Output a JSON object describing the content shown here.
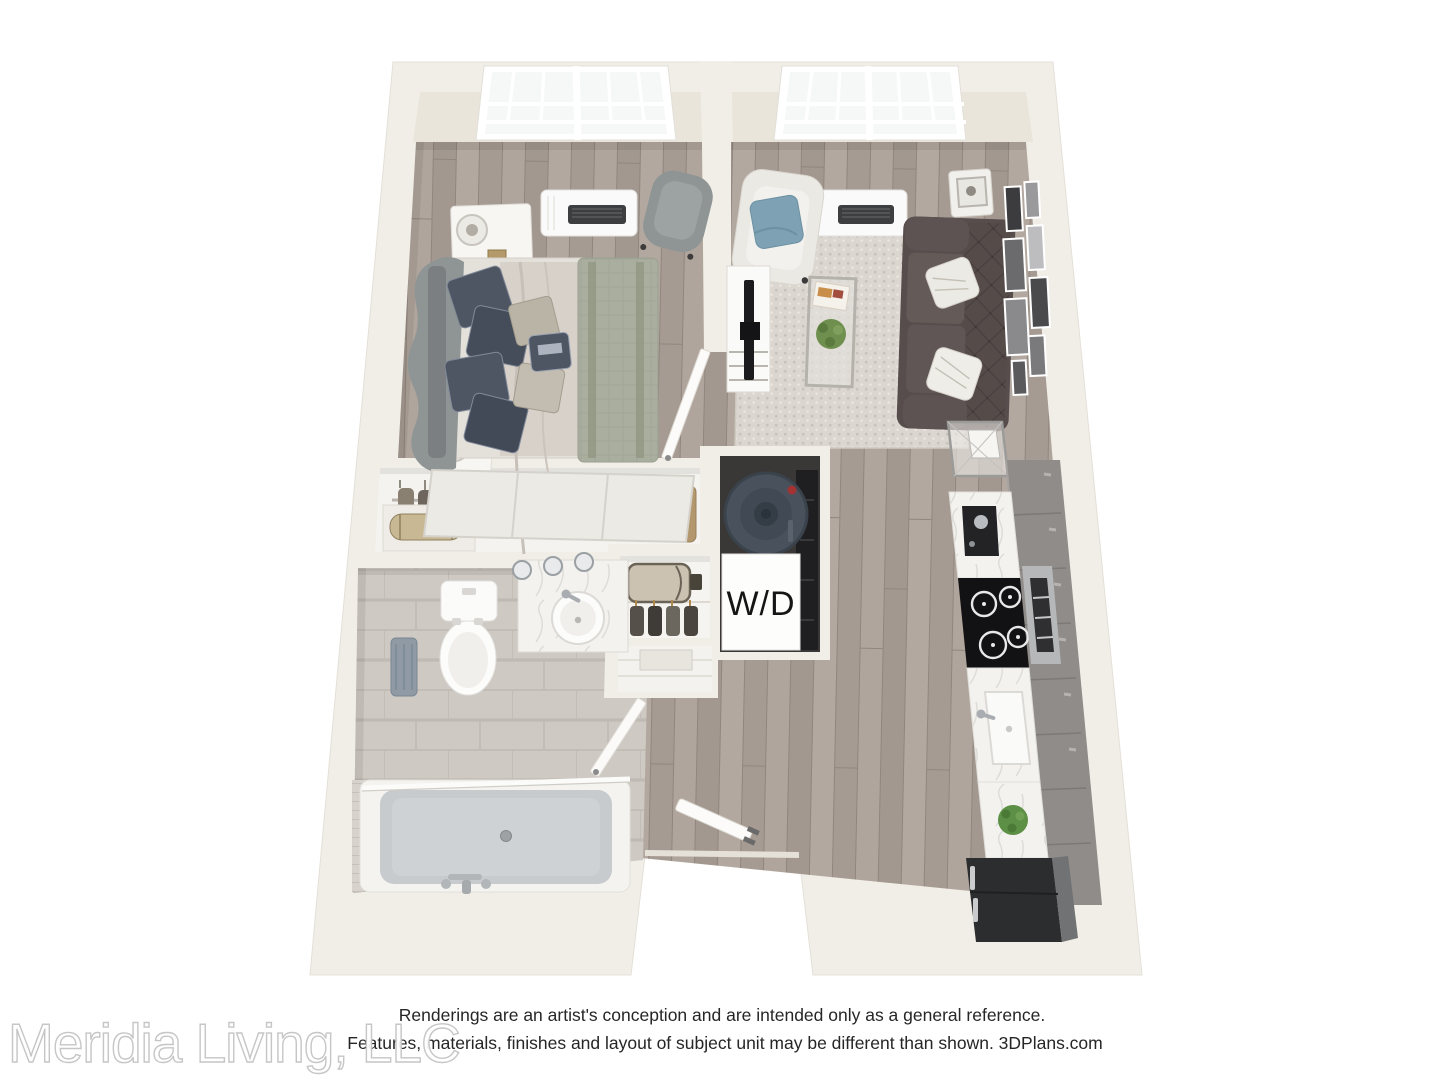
{
  "floorplan": {
    "laundry_label": "W/D"
  },
  "footer": {
    "disclaimer_line1": "Renderings are an artist's conception and are intended only as a general reference.",
    "disclaimer_line2": "Features, materials, finishes and layout of subject unit may be different than shown. 3DPlans.com",
    "watermark": "Meridia Living, LLC"
  },
  "palette": {
    "background": "#ffffff",
    "wall_top": "#f1eee8",
    "wall_inner_face": "#e9e5db",
    "wood_floor": "#aba098",
    "bathroom_tile": "#cec9c2",
    "area_rug": "#dbd7d0",
    "sofa": "#554b49",
    "accent_pillow": "#7ea2b4",
    "bed_blanket": "#a9ae9f",
    "bed_pillow_navy": "#4e5663",
    "kitchen_cabinet": "#8f8c89",
    "counter_marble": "#f3f2ef",
    "appliance_dark": "#232325",
    "refrigerator": "#2c2d2f",
    "tub_interior": "#c7cbcd",
    "water_heater": "#49525c",
    "disclaimer_text": "#262626",
    "watermark_stroke": "#c6c6c6"
  }
}
